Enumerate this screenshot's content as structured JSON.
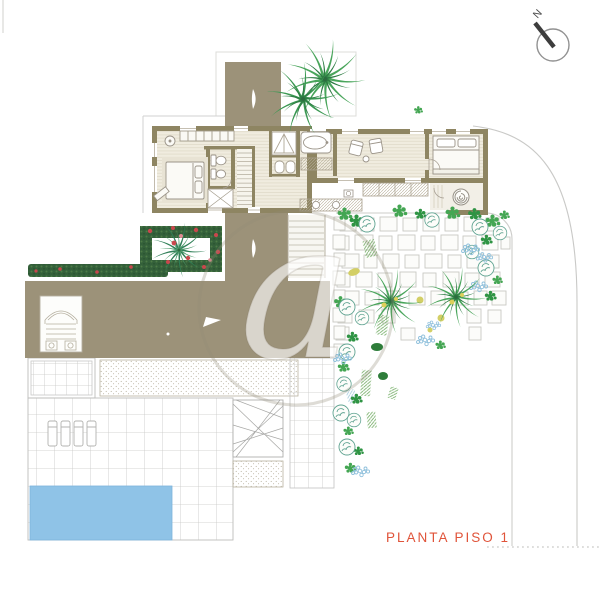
{
  "plan": {
    "title": "PLANTA PISO 1"
  },
  "compass": {
    "north": "N"
  },
  "watermark": {
    "letter": "a"
  },
  "palette": {
    "roof_taupe": "#9c9279",
    "wall_olive": "#8e8562",
    "floor_cream": "#f0ecdf",
    "pool_blue": "#8fc3e7",
    "hedge_green": "#34603a",
    "flower_red": "#c9474d",
    "foliage_green": "#44a653",
    "tree_teal": "#5fa391",
    "flower_blue": "#8fc0dc",
    "palm_yellow": "#ddd05a",
    "label_orange": "#e0543a",
    "line_gray": "#c9c9c7"
  }
}
